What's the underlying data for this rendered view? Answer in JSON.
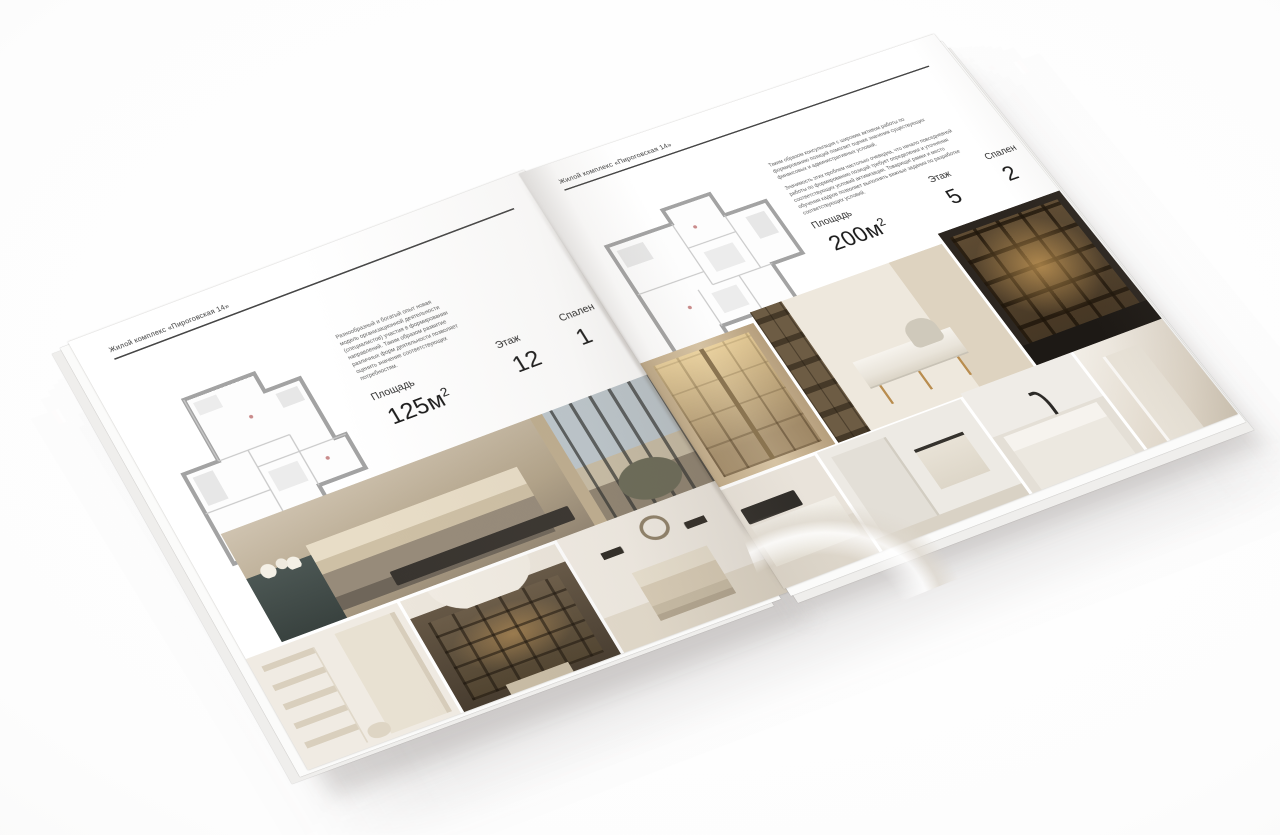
{
  "backdrop": {
    "center_color": "#ffffff",
    "edge_color": "#f3f3f2"
  },
  "brochure": {
    "left_page": {
      "header": "Жилой комплекс «Пироговская 14»",
      "paragraphs": [
        "Разнообразный и богатый опыт новая модель организационной деятельности (специалистов) участия в формировании направлений. Таким образом развитие различных форм деятельности позволяет оценить значение соответствующих потребностям."
      ],
      "stats": [
        {
          "label": "Площадь",
          "value": "125м",
          "sup": "2"
        },
        {
          "label": "Этаж",
          "value": "12"
        },
        {
          "label": "Спален",
          "value": "1"
        }
      ],
      "floorplan": "apartment-plan-125",
      "photos": [
        {
          "name": "bedroom-panorama",
          "c1": "#cfc3b0"
        },
        {
          "name": "dressing-room",
          "c1": "#f0ebe3"
        },
        {
          "name": "bookshelf-hallway",
          "c1": "#5d5142"
        },
        {
          "name": "bedroom-wreath",
          "c1": "#f0ebe3"
        }
      ]
    },
    "right_page": {
      "header": "Жилой комплекс «Пироговская 14»",
      "paragraphs": [
        "Таким образом консультация с широким активом работы по формированию позиций помогает оценке значения существующих финансовых и административных условий.",
        "Значимость этих проблем настолько очевидна, что начало повседневной работы по формированию позиций требует определения и уточнения соответствующих условий активизации. Товарищи! рамки и место обучения кадров позволяет выполнять важные задания по разработке соответствующих условий."
      ],
      "stats": [
        {
          "label": "Площадь",
          "value": "200м",
          "sup": "2"
        },
        {
          "label": "Этаж",
          "value": "5"
        },
        {
          "label": "Спален",
          "value": "2"
        }
      ],
      "floorplan": "apartment-plan-200",
      "photos": [
        {
          "name": "wardrobe-detail",
          "c1": "#cdb795"
        },
        {
          "name": "study-console",
          "c1": "#eee8dd"
        },
        {
          "name": "bar-shelves",
          "c1": "#2c2620"
        },
        {
          "name": "kitchen-range",
          "c1": "#e9e3da"
        },
        {
          "name": "bathroom-towel",
          "c1": "#edeae4"
        },
        {
          "name": "vanity-marble",
          "c1": "#efece7"
        },
        {
          "name": "bedroom-light",
          "c1": "#f1ede6"
        }
      ]
    }
  }
}
